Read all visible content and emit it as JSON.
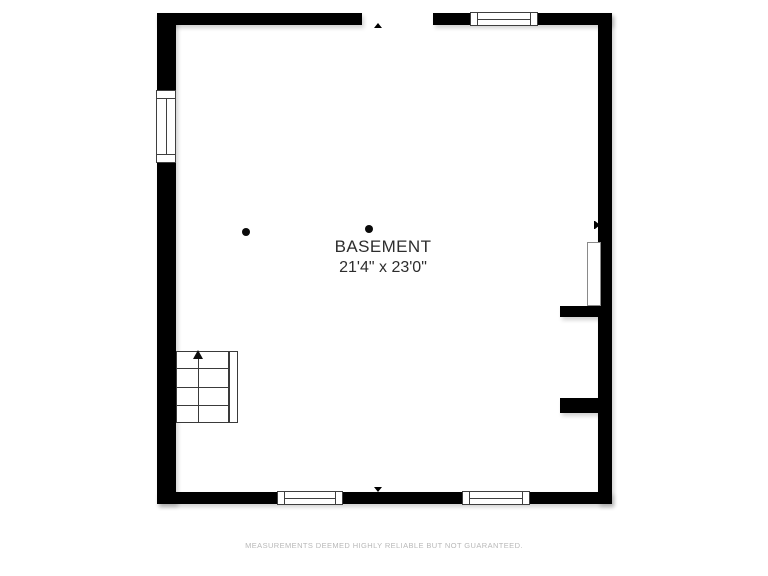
{
  "floorplan": {
    "room": {
      "label": "BASEMENT",
      "dimensions": "21'4\" x 23'0\""
    },
    "disclaimer": "MEASUREMENTS DEEMED HIGHLY RELIABLE BUT NOT GUARANTEED.",
    "colors": {
      "wall": "#000000",
      "background": "#ffffff",
      "label_text": "#2d2d2d",
      "symbol_line": "#3a3a3a",
      "disclaimer_text": "#b8b8b8"
    },
    "symbols": {
      "windows": [
        "window-top",
        "window-left",
        "window-bottom-left",
        "window-bottom-right"
      ],
      "support_columns": 2,
      "staircase_direction": "up",
      "entry_markers": [
        "top",
        "right",
        "bottom"
      ]
    }
  }
}
